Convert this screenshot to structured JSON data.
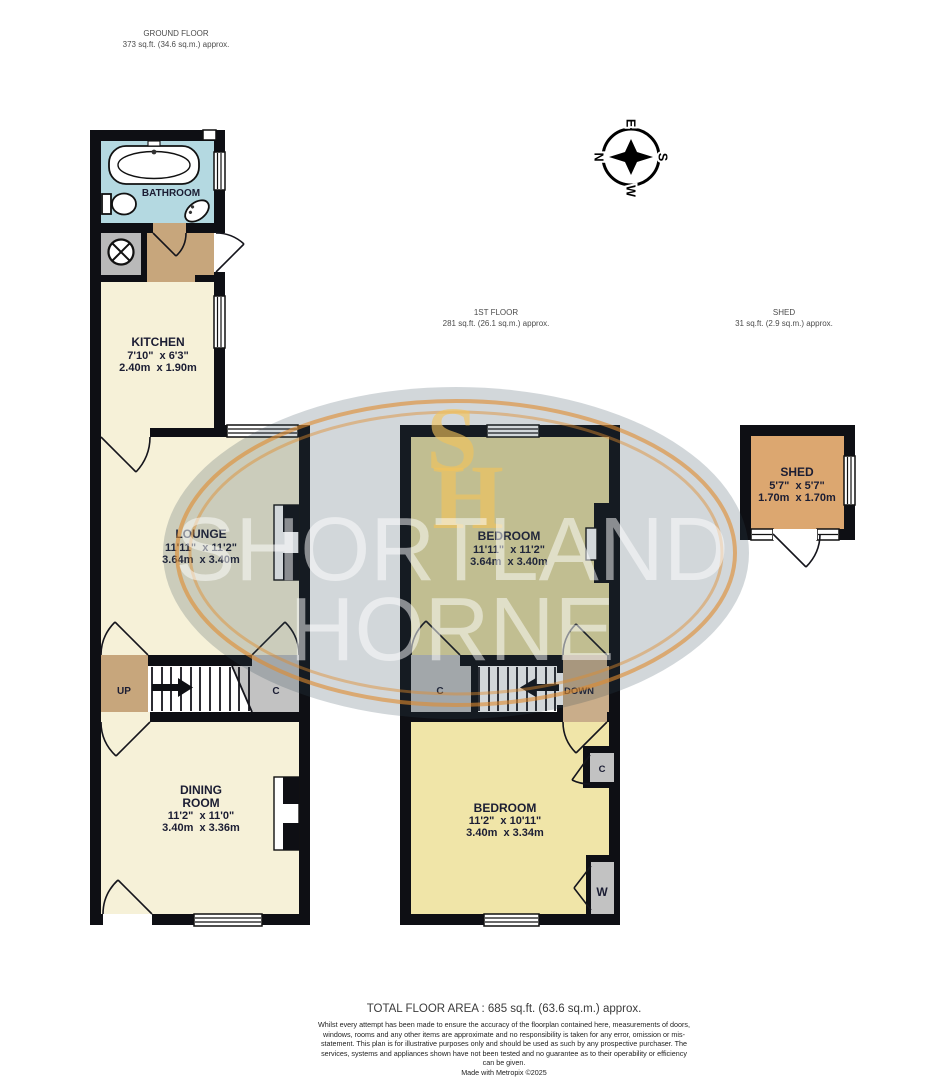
{
  "titles": {
    "ground": {
      "name": "GROUND FLOOR",
      "area": "373 sq.ft. (34.6 sq.m.) approx."
    },
    "first": {
      "name": "1ST FLOOR",
      "area": "281 sq.ft. (26.1 sq.m.) approx."
    },
    "shed": {
      "name": "SHED",
      "area": "31 sq.ft. (2.9 sq.m.) approx."
    }
  },
  "rooms": {
    "bathroom": {
      "name": "BATHROOM"
    },
    "kitchen": {
      "name": "KITCHEN",
      "imperial": "7'10\"  x 6'3\"",
      "metric": "2.40m  x 1.90m"
    },
    "lounge": {
      "name": "LOUNGE",
      "imperial": "11'11\"  x 11'2\"",
      "metric": "3.64m  x 3.40m"
    },
    "dining": {
      "line1": "DINING",
      "line2": "ROOM",
      "imperial": "11'2\"  x 11'0\"",
      "metric": "3.40m  x 3.36m"
    },
    "bedroom1": {
      "name": "BEDROOM",
      "imperial": "11'11\"  x 11'2\"",
      "metric": "3.64m  x 3.40m"
    },
    "bedroom2": {
      "name": "BEDROOM",
      "imperial": "11'2\"  x 10'11\"",
      "metric": "3.40m  x 3.34m"
    },
    "shed": {
      "name": "SHED",
      "imperial": "5'7\"  x 5'7\"",
      "metric": "1.70m  x 1.70m"
    }
  },
  "stairs": {
    "up": "UP",
    "down": "DOWN"
  },
  "storage": {
    "cupboard": "C",
    "wardrobe": "W"
  },
  "compass": {
    "north": "N",
    "east": "E",
    "south": "S",
    "west": "W"
  },
  "watermark": {
    "word1": "SHORTLAND",
    "word2": "HORNE",
    "monogram_top": "S",
    "monogram_bottom": "H"
  },
  "footer": {
    "total": "TOTAL FLOOR AREA : 685 sq.ft. (63.6 sq.m.) approx.",
    "disclaimer": "Whilst every attempt has been made to ensure the accuracy of the floorplan contained here, measurements of doors, windows, rooms and any other items are approximate and no responsibility is taken for any error, omission or mis-statement. This plan is for illustrative purposes only and should be used as such by any prospective purchaser. The services, systems and appliances shown have not been tested and no guarantee as to their operability or efficiency can be given.",
    "credit": "Made with Metropix ©2025"
  },
  "colors": {
    "wall": "#0e0f14",
    "bathroom": "#b4d9e1",
    "cream": "#f6f1d8",
    "yellow": "#eadfa2",
    "yellow_bright": "#f0e5a8",
    "tan": "#c7a67c",
    "tan_light": "#c9ad8a",
    "gray": "#c2c2c2",
    "gray_dark": "#b9b9b9",
    "shed": "#dca770",
    "accent": "#e08b2d"
  }
}
